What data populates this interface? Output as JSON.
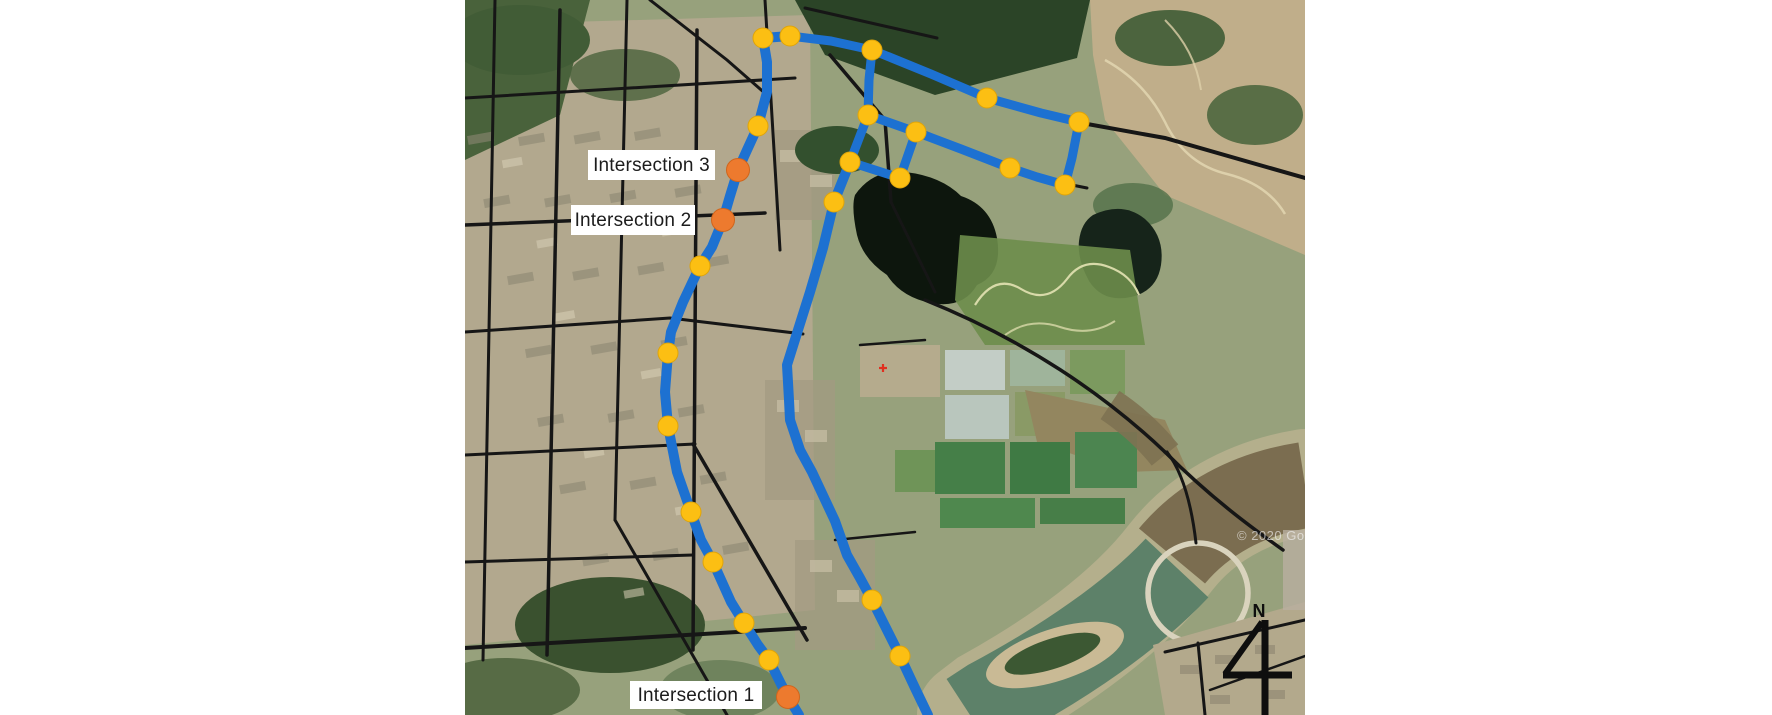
{
  "figure": {
    "type": "satellite-route-map",
    "credit_watermark": "© 2020 Goog",
    "compass": {
      "label": "N"
    }
  },
  "map": {
    "size": {
      "width": 840,
      "height": 715,
      "offset_x": 465
    },
    "colors": {
      "route": "#1d71d1",
      "node_fill": "#fcbf13",
      "node_stroke": "#dfa409",
      "key_fill": "#ed7a2e",
      "key_stroke": "#d0651c",
      "label_bg": "#ffffff",
      "label_text": "#1c1c1c"
    },
    "intersection_labels": [
      {
        "text": "Intersection 3",
        "x": 123,
        "y": 150,
        "w": 127,
        "h": 30
      },
      {
        "text": "Intersection 2",
        "x": 106,
        "y": 205,
        "w": 124,
        "h": 30
      },
      {
        "text": "Intersection 1",
        "x": 165,
        "y": 681,
        "w": 132,
        "h": 28
      }
    ],
    "key_intersections": [
      {
        "id": 3,
        "name": "Intersection 3",
        "x": 273,
        "y": 170
      },
      {
        "id": 2,
        "name": "Intersection 2",
        "x": 258,
        "y": 220
      },
      {
        "id": 1,
        "name": "Intersection 1",
        "x": 323,
        "y": 697
      }
    ],
    "route_nodes": [
      {
        "x": 298,
        "y": 38
      },
      {
        "x": 325,
        "y": 36
      },
      {
        "x": 293,
        "y": 126
      },
      {
        "x": 235,
        "y": 266
      },
      {
        "x": 203,
        "y": 353
      },
      {
        "x": 203,
        "y": 426
      },
      {
        "x": 226,
        "y": 512
      },
      {
        "x": 248,
        "y": 562
      },
      {
        "x": 279,
        "y": 623
      },
      {
        "x": 304,
        "y": 660
      },
      {
        "x": 407,
        "y": 50
      },
      {
        "x": 522,
        "y": 98
      },
      {
        "x": 614,
        "y": 122
      },
      {
        "x": 600,
        "y": 185
      },
      {
        "x": 545,
        "y": 168
      },
      {
        "x": 451,
        "y": 132
      },
      {
        "x": 403,
        "y": 115
      },
      {
        "x": 385,
        "y": 162
      },
      {
        "x": 435,
        "y": 178
      },
      {
        "x": 369,
        "y": 202
      },
      {
        "x": 407,
        "y": 600
      },
      {
        "x": 435,
        "y": 656
      }
    ],
    "routes": [
      {
        "name": "route-west",
        "width": 10,
        "points": [
          [
            298,
            38
          ],
          [
            302,
            62
          ],
          [
            302,
            92
          ],
          [
            293,
            126
          ],
          [
            282,
            150
          ],
          [
            273,
            170
          ],
          [
            265,
            196
          ],
          [
            258,
            220
          ],
          [
            247,
            247
          ],
          [
            235,
            266
          ],
          [
            218,
            302
          ],
          [
            206,
            332
          ],
          [
            203,
            353
          ],
          [
            200,
            392
          ],
          [
            203,
            426
          ],
          [
            212,
            472
          ],
          [
            226,
            512
          ],
          [
            236,
            540
          ],
          [
            248,
            562
          ],
          [
            266,
            602
          ],
          [
            279,
            623
          ],
          [
            293,
            645
          ],
          [
            304,
            660
          ],
          [
            316,
            684
          ],
          [
            323,
            697
          ],
          [
            334,
            715
          ]
        ]
      },
      {
        "name": "route-west-top-link",
        "width": 10,
        "points": [
          [
            298,
            38
          ],
          [
            325,
            36
          ]
        ]
      },
      {
        "name": "route-northeast-loop",
        "width": 9,
        "points": [
          [
            325,
            36
          ],
          [
            366,
            41
          ],
          [
            407,
            50
          ],
          [
            466,
            74
          ],
          [
            522,
            98
          ],
          [
            576,
            113
          ],
          [
            614,
            122
          ],
          [
            607,
            158
          ],
          [
            600,
            185
          ],
          [
            572,
            177
          ],
          [
            545,
            168
          ],
          [
            496,
            149
          ],
          [
            451,
            132
          ],
          [
            403,
            115
          ],
          [
            404,
            80
          ],
          [
            407,
            50
          ]
        ]
      },
      {
        "name": "loop-inner-link-a",
        "width": 9,
        "points": [
          [
            403,
            115
          ],
          [
            385,
            162
          ]
        ]
      },
      {
        "name": "loop-inner-link-b",
        "width": 9,
        "points": [
          [
            385,
            162
          ],
          [
            435,
            178
          ],
          [
            451,
            132
          ]
        ]
      },
      {
        "name": "route-central",
        "width": 10,
        "points": [
          [
            385,
            162
          ],
          [
            369,
            202
          ],
          [
            358,
            248
          ],
          [
            345,
            292
          ],
          [
            333,
            330
          ],
          [
            322,
            365
          ],
          [
            324,
            400
          ],
          [
            325,
            420
          ],
          [
            335,
            450
          ],
          [
            347,
            472
          ],
          [
            370,
            521
          ],
          [
            382,
            555
          ],
          [
            395,
            578
          ],
          [
            407,
            600
          ],
          [
            421,
            628
          ],
          [
            435,
            656
          ],
          [
            450,
            688
          ],
          [
            463,
            715
          ]
        ]
      }
    ]
  }
}
